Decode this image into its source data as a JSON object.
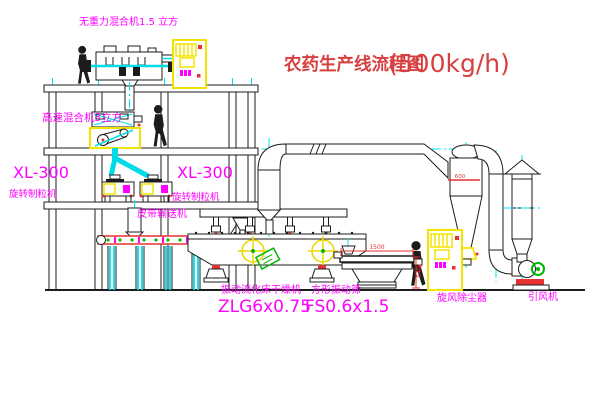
{
  "title": {
    "name": "农药生产线流程图",
    "capacity": "(500kg/h)"
  },
  "labels": {
    "gravityless_mixer": "无重力混合机1.5 立方",
    "high_speed_mixer": "高速混合机3立方",
    "granulator_left_model": "XL-300",
    "granulator_left_name": "旋转制粒机",
    "granulator_right_model": "XL-300",
    "granulator_right_name": "旋转制粒机",
    "belt_conveyor": "皮带输送机",
    "dryer_name": "振动流化床干燥机",
    "dryer_model": "ZLG6x0.75",
    "sieve_name": "方形振动筛",
    "sieve_model": "FS0.6x1.5",
    "cyclone": "旋风除尘器",
    "fan": "引风机"
  },
  "dimensions": {
    "sieve_width": "1500",
    "sieve_height": "540",
    "cyclone_level": "600"
  },
  "colors": {
    "label_magenta": "#ff00ff",
    "title_red": "#d84040",
    "line_black": "#1c1c1c",
    "equipment_yellow": "#f2e400",
    "pipe_cyan": "#00dbe8",
    "accent_green": "#00b400",
    "accent_red": "#e83030"
  }
}
